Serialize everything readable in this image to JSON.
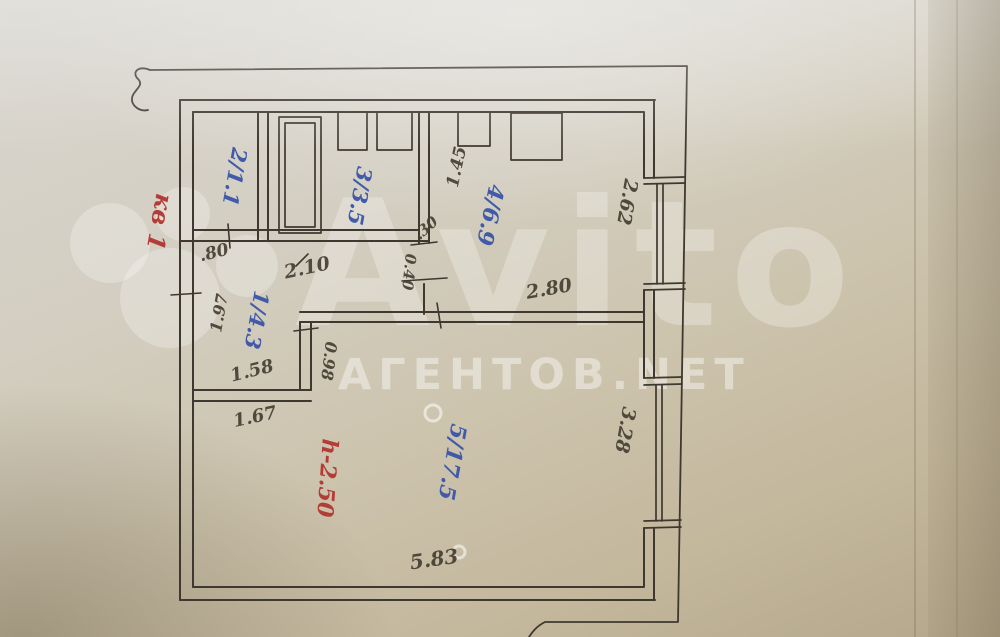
{
  "plan": {
    "rooms": [
      {
        "key": "closet",
        "label": "2/1.1"
      },
      {
        "key": "bath",
        "label": "3/3.5"
      },
      {
        "key": "kitchen",
        "label": "4/6.9"
      },
      {
        "key": "hall",
        "label": "1/4.3"
      },
      {
        "key": "living",
        "label": "5/17.5"
      }
    ],
    "dims": {
      "w80": ".80",
      "w210": "2.10",
      "w145": "1.45",
      "w30": ".30",
      "w040": "0.40",
      "w262": "2.62",
      "w280": "2.80",
      "w197": "1.97",
      "w098": "0.98",
      "w158": "1.58",
      "w167": "1.67",
      "w328": "3.28",
      "w583": "5.83"
    },
    "notes": {
      "apartment": "кв 1",
      "height": "h-2.50"
    }
  },
  "watermark": {
    "brand": "Avito",
    "site": "АГЕНТОВ.NET"
  },
  "colors": {
    "ink": "#3f3831",
    "blue_ink": "#3a55a8",
    "red_ink": "#b23530",
    "paper": "#cfc7b3"
  }
}
